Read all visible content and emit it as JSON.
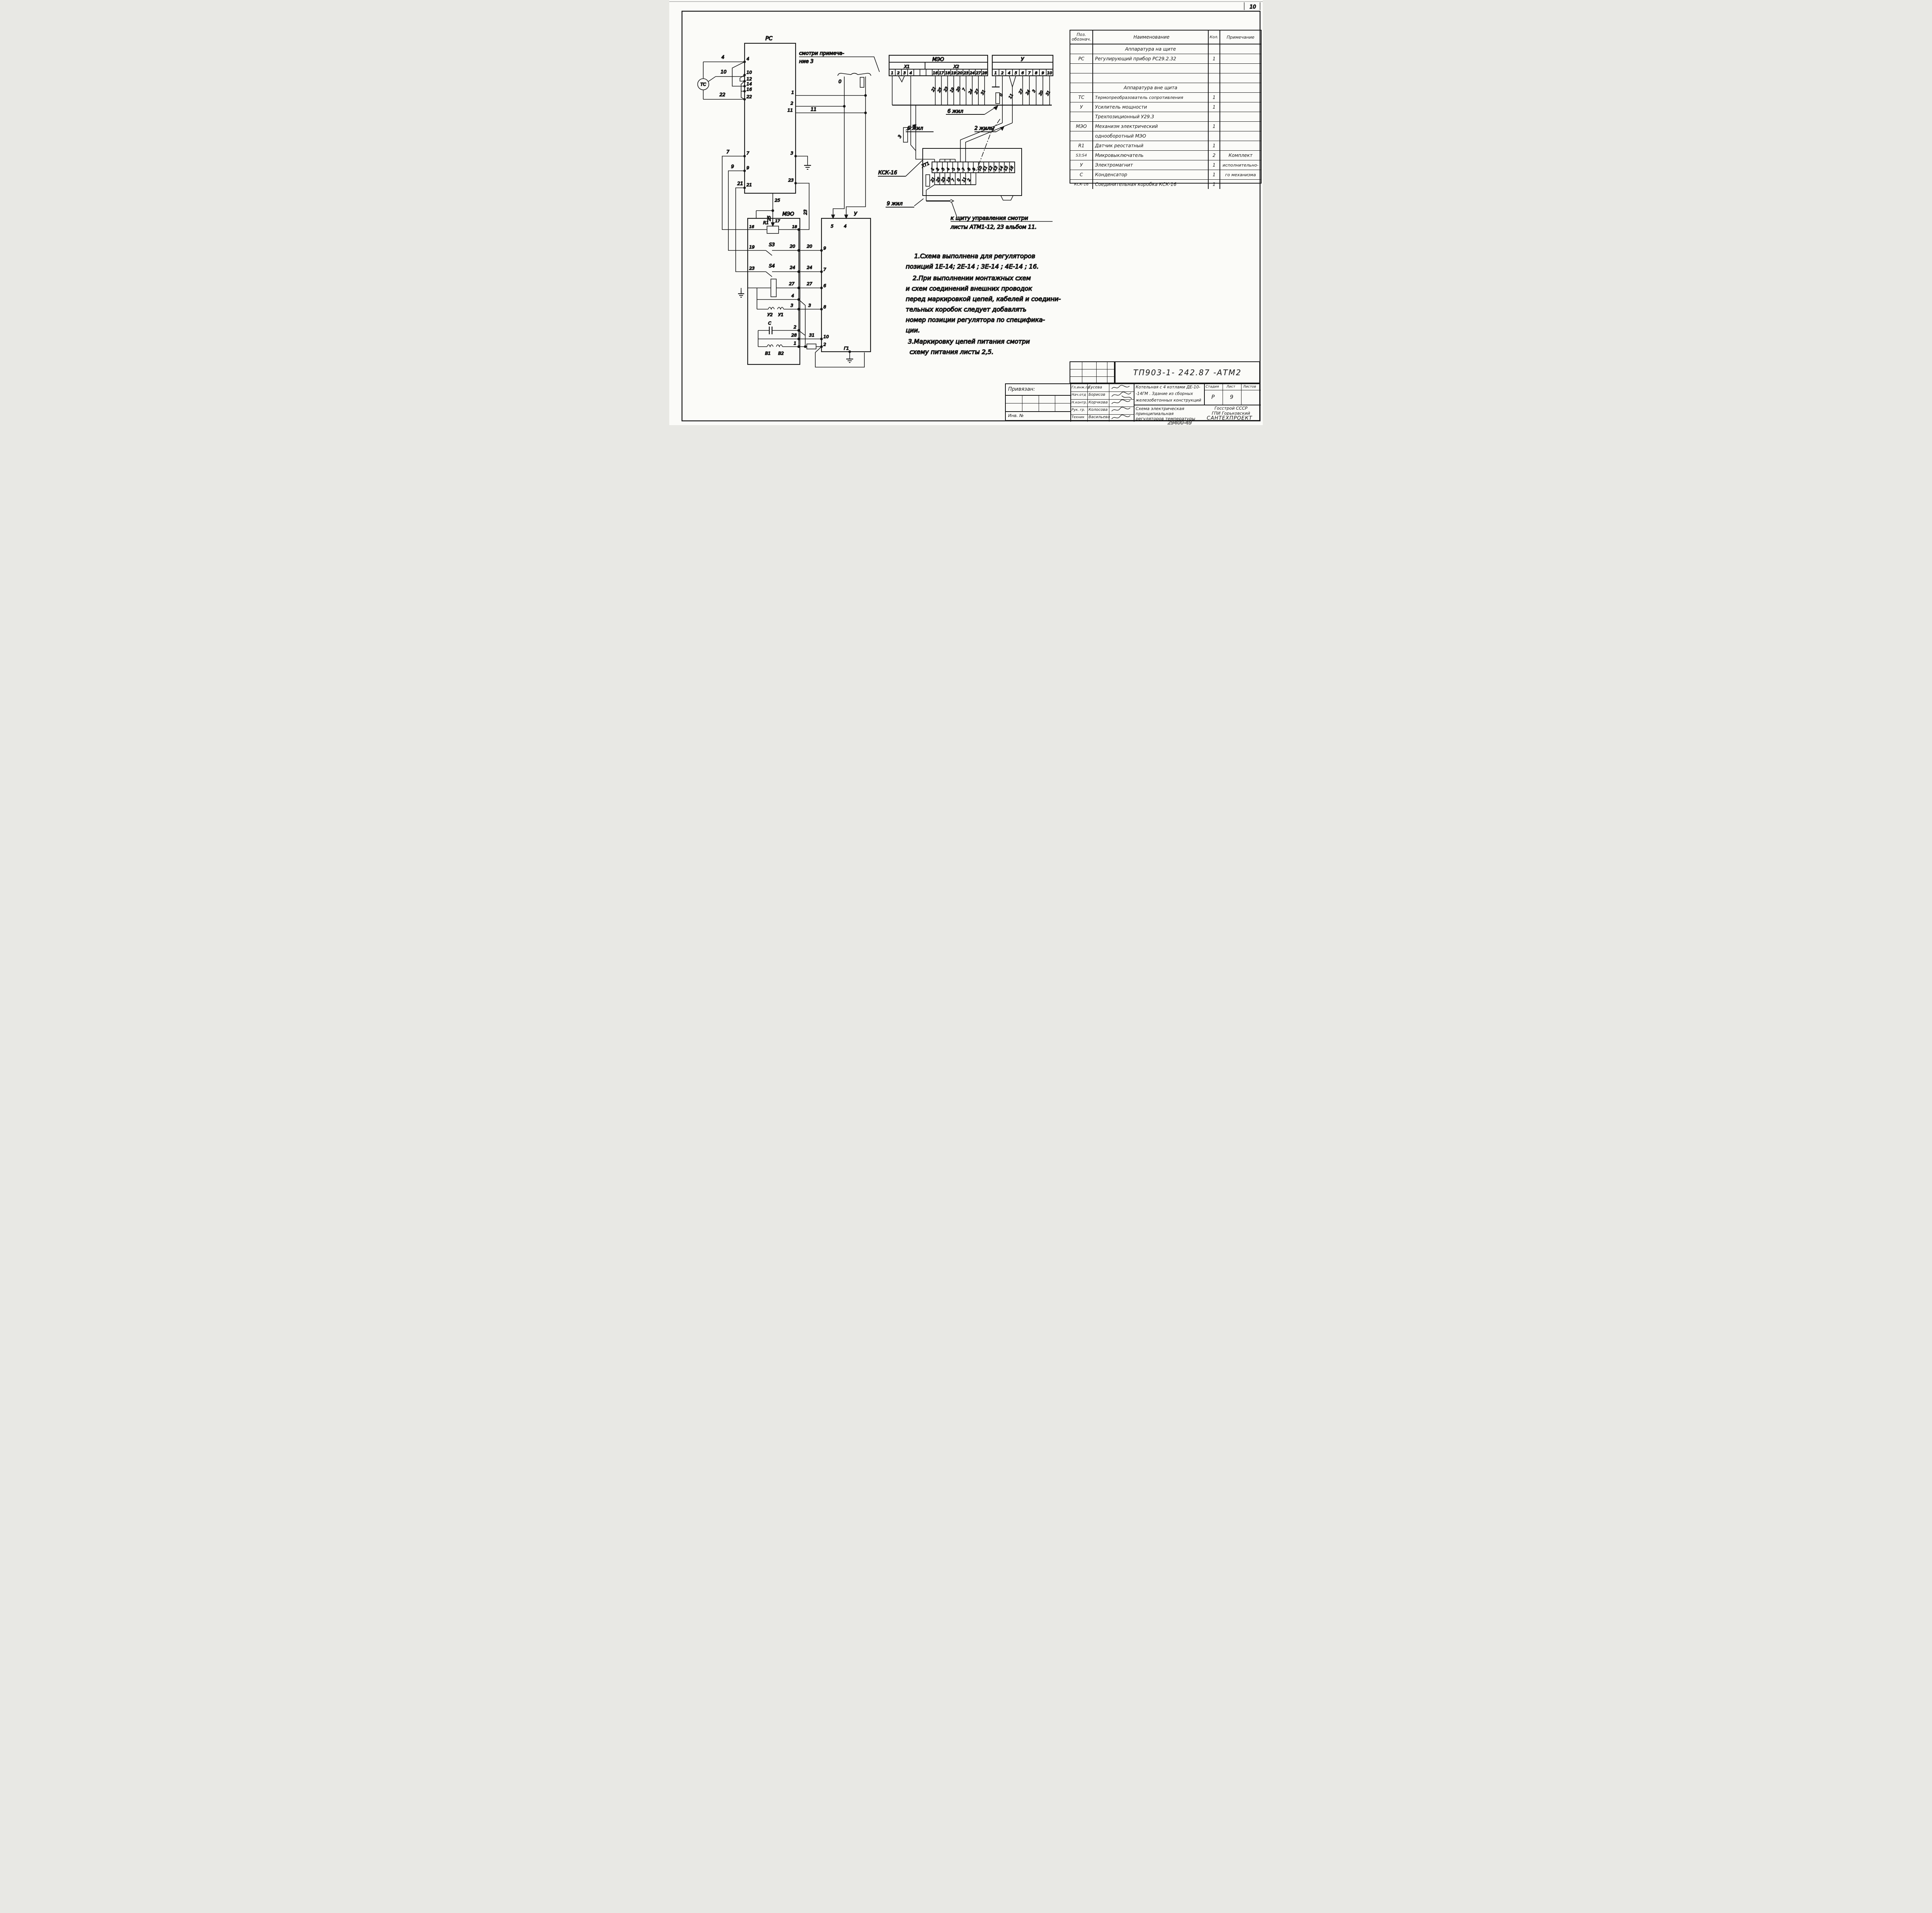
{
  "frame": {
    "sheet_no": "10",
    "doc_stamp": "29400-49"
  },
  "schematic": {
    "tc": {
      "label": "ТС"
    },
    "rc": {
      "label": "РС",
      "pin4": "4",
      "pin10": "10",
      "pin12": "12",
      "pin14": "14",
      "pin16": "16",
      "pin22": "22",
      "pin7": "7",
      "pin9": "9",
      "pin21": "21",
      "pin1": "1",
      "pin2": "2",
      "pin11": "11",
      "pin3": "3",
      "pin23": "23",
      "pin25": "25"
    },
    "wires": {
      "w4": "4",
      "w10": "10",
      "w22": "22",
      "w7": "7",
      "w9": "9",
      "w21": "21",
      "w11": "11",
      "w0": "0",
      "w23": "23",
      "w25a": "25",
      "w25b": "25",
      "w3x1": "3"
    },
    "note_ref": {
      "l1": "смотри примеча-",
      "l2": "ние 3"
    },
    "meo_conn": {
      "title": "МЭО",
      "x1": "X1",
      "x2": "X2",
      "t": [
        "1",
        "2",
        "3",
        "4",
        "16",
        "17",
        "18",
        "19",
        "20",
        "23",
        "24",
        "27",
        "28"
      ],
      "w": [
        "21",
        "25",
        "23",
        "19",
        "20",
        "7",
        "24",
        "27",
        "31"
      ]
    },
    "u_conn": {
      "title": "У",
      "t": [
        "1",
        "2",
        "4",
        "5",
        "6",
        "7",
        "8",
        "9",
        "10"
      ],
      "w": [
        "0",
        "11",
        "27",
        "24",
        "3",
        "20",
        "31"
      ]
    },
    "cables": {
      "six_left": "6 жил",
      "six_right": "6 жил",
      "two": "2 жилы",
      "nine": "9 жил"
    },
    "ksk": {
      "label": "КСК-16",
      "strip": "ХТ1",
      "t": [
        "1",
        "2",
        "3",
        "4",
        "5",
        "6",
        "7",
        "8",
        "9",
        "10",
        "11",
        "12",
        "13",
        "14",
        "15",
        "16"
      ],
      "w": [
        "21",
        "25",
        "23",
        "19",
        "7",
        "0",
        "11",
        "2"
      ]
    },
    "to_panel": {
      "l1": "к щиту управления смотри",
      "l2": "листы АТМ1-12, 23 альбом 11."
    },
    "meo": {
      "label": "МЭО",
      "r1": "R1",
      "t16": "16",
      "t17": "17",
      "t18": "18",
      "s3": "S3",
      "s4": "S4",
      "w19": "19",
      "w20a": "20",
      "w20b": "20",
      "w23": "23",
      "w24a": "24",
      "w24b": "24",
      "w27a": "27",
      "w27b": "27",
      "w4": "4",
      "w3a": "3",
      "w3b": "3",
      "u2": "У2",
      "u1": "У1",
      "cap": "С",
      "w2": "2",
      "w28": "28",
      "w31": "31",
      "v1": "В1",
      "v2": "В2",
      "w1": "1"
    },
    "u": {
      "label": "У",
      "p5": "5",
      "p4": "4",
      "p9": "9",
      "p7": "7",
      "p6": "6",
      "p8": "8",
      "p10": "10",
      "p2": "2",
      "g1": "Г1"
    }
  },
  "notes": [
    "1.Схема  выполнена  для  регуляторов",
    "позиций   1Е-14; 2Е-14 ; 3Е-14 ; 4Е-14 ; 16.",
    "2.При  выполнении   монтажных   схем",
    "и схем    соединений  внешних   проводок",
    "перед   маркировкой цепей, кабелей и соедини-",
    "тельных      коробок   следует   добавлять",
    "номер  позиции   регулятора  по специфика-",
    "ции.",
    "3.Маркировку  цепей   питания  смотри",
    "схему  питания  листы 2,5."
  ],
  "table": {
    "h_pos1": "Поз.",
    "h_pos2": "обознач.",
    "h_name": "Наименование",
    "h_qty": "Кол.",
    "h_note": "Примечание",
    "rows": [
      {
        "pos": "",
        "name": "Аппаратура   на щите",
        "qty": "",
        "note": ""
      },
      {
        "pos": "РС",
        "name": "Регулирующий  прибор  РС29.2.32",
        "qty": "1",
        "note": ""
      },
      {
        "pos": "",
        "name": "",
        "qty": "",
        "note": ""
      },
      {
        "pos": "",
        "name": "",
        "qty": "",
        "note": ""
      },
      {
        "pos": "",
        "name": "Аппаратура  вне щита",
        "qty": "",
        "note": ""
      },
      {
        "pos": "ТС",
        "name": "Термопреобразователь сопротивления",
        "qty": "1",
        "note": ""
      },
      {
        "pos": "У",
        "name": "Усилитель  мощности",
        "qty": "1",
        "note": ""
      },
      {
        "pos": "",
        "name": "Трехпозиционный  У29.3",
        "qty": "",
        "note": ""
      },
      {
        "pos": "МЭО",
        "name": "Механизм  электрический",
        "qty": "1",
        "note": ""
      },
      {
        "pos": "",
        "name": "однооборотный   МЭО",
        "qty": "",
        "note": ""
      },
      {
        "pos": "R1",
        "name": "Датчик  реостатный",
        "qty": "1",
        "note": ""
      },
      {
        "pos": "S3;S4",
        "name": "Микровыключатель",
        "qty": "2",
        "note": "Комплект"
      },
      {
        "pos": "У",
        "name": "Электромагнит",
        "qty": "1",
        "note": "исполнительно-"
      },
      {
        "pos": "С",
        "name": "Конденсатор",
        "qty": "1",
        "note": "го механизма"
      },
      {
        "pos": "КСК-16",
        "name": "Соединительная  коробка  КСК-16",
        "qty": "1",
        "note": ""
      }
    ]
  },
  "tb": {
    "doc": "ТП903-1- 242.87   -АТМ2",
    "privyazan": "Привязан:",
    "inv": "Инв. №",
    "roles": [
      {
        "role": "Гл.инж.пр.",
        "name": "Гусева"
      },
      {
        "role": "Нач.отд",
        "name": "Борисов"
      },
      {
        "role": "Н.контр.",
        "name": "Корчкова"
      },
      {
        "role": "Рук. гр.",
        "name": "Колосова"
      },
      {
        "role": "Техник",
        "name": "Васильева"
      }
    ],
    "obj": [
      "Котельная с 4 котлами ДЕ-10-",
      "-14ГМ . Здание  из  сборных",
      "железобетонных конструкций"
    ],
    "stage_h": "Стадия",
    "list_h": "Лист",
    "listov_h": "Листов",
    "stage": "Р",
    "list": "9",
    "listov": "",
    "title": [
      "Схема  электрическая",
      "принципиальная",
      "регуляторов  температуры"
    ],
    "org": [
      "Госстрой СССР",
      "ГПИ  Горьковский",
      "САНТЕХПРОЕКТ"
    ]
  }
}
